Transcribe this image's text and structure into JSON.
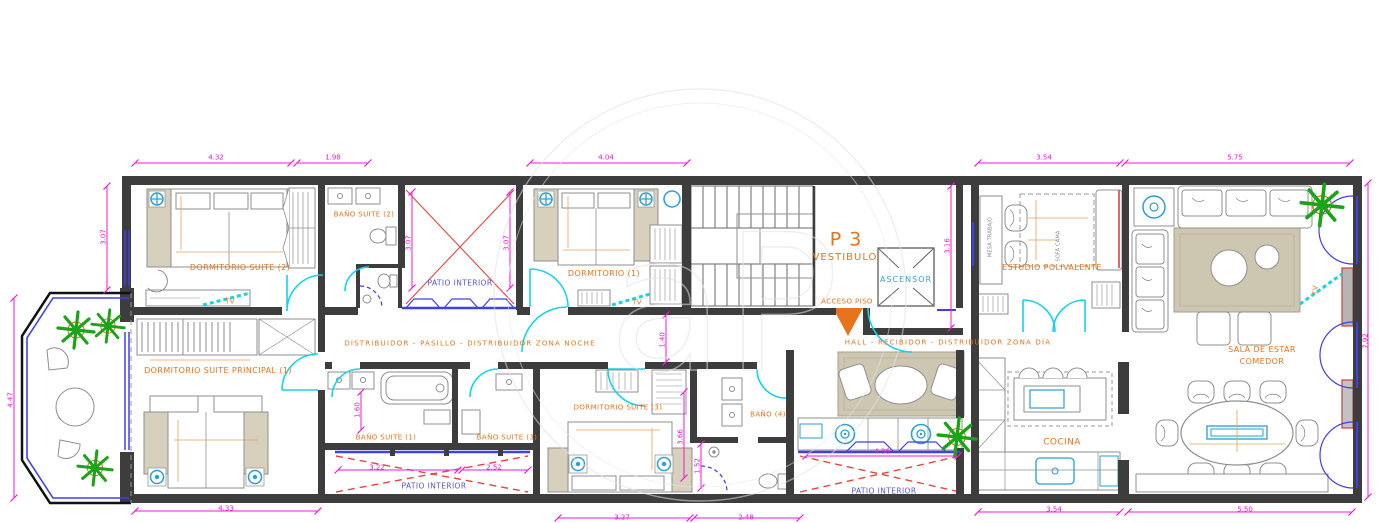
{
  "title": "Floor plan P3",
  "labels": {
    "dormitorio_suite_2": "DORMITORIO SUITE  (2)",
    "bano_suite_2": "BAÑO SUITE  (2)",
    "patio_interior_top": "PATIO INTERIOR",
    "dormitorio_1": "DORMITORIO  (1)",
    "p3": "P 3",
    "vestibulo": "VESTIBULO",
    "ascensor": "ASCENSOR",
    "acceso_piso": "ACCESO PISO",
    "estudio_polivalente": "ESTUDIO POLIVALENTE",
    "sala_line1": "SALA DE ESTAR",
    "sala_line2": "COMEDOR",
    "pasillo_noche": "DISTRIBUIDOR  -  PASILLO  -  DISTRIBUIDOR  ZONA  NOCHE",
    "hall_dia": "HALL  -  RECIBIDOR  -  DISTRIBUIDOR  ZONA  DÍA",
    "dormitorio_principal": "DORMITORIO SUITE PRINCIPAL (1)",
    "bano_suite_1": "BAÑO SUITE (1)",
    "bano_suite_3": "BAÑO SUITE (3)",
    "dormitorio_suite_3": "DORMITORIO SUITE (3)",
    "bano_4": "BAÑO (4)",
    "patio_interior_bl": "PATIO INTERIOR",
    "patio_interior_br": "PATIO INTERIOR",
    "cocina": "COCINA",
    "tv_suite2": "TV",
    "tv_dorm1": "TV",
    "tv_sala": "TV",
    "mesa_trabajo": "MESA TRABAJO",
    "sofa_cama": "SOFÁ CAMA",
    "watermark": "aP"
  },
  "dimensions": {
    "top_1": "4.32",
    "top_2": "1.98",
    "top_3": "4.04",
    "top_4": "3.54",
    "top_5": "5.75",
    "left_1": "3.07",
    "left_2": "4.47",
    "patio_top_l": "3.07",
    "patio_top_r": "3.07",
    "right_1": "3.16",
    "right_2": "7.92",
    "corridor": "1.40",
    "inner_1": "1.60",
    "inner_2": "3.66",
    "inner_3": "1.52",
    "patio_bl_1": "3.22",
    "patio_bl_2": "2.52",
    "patio_br_1": "4.36",
    "bottom_1": "4.33",
    "bottom_2": "3.27",
    "bottom_3": "2.48",
    "bottom_4": "3.54",
    "bottom_5": "5.50"
  },
  "colors": {
    "wall": "#3d3d3d",
    "room_label": "#e8731c",
    "patio_label": "#5555d6",
    "dimension": "#f318d4",
    "door": "#18d2e8",
    "window": "#3c3cf0",
    "patio_cross": "#e84545",
    "plant": "#1ca418",
    "rug": "#cdc7b2",
    "appliance": "#2a9fd0"
  }
}
